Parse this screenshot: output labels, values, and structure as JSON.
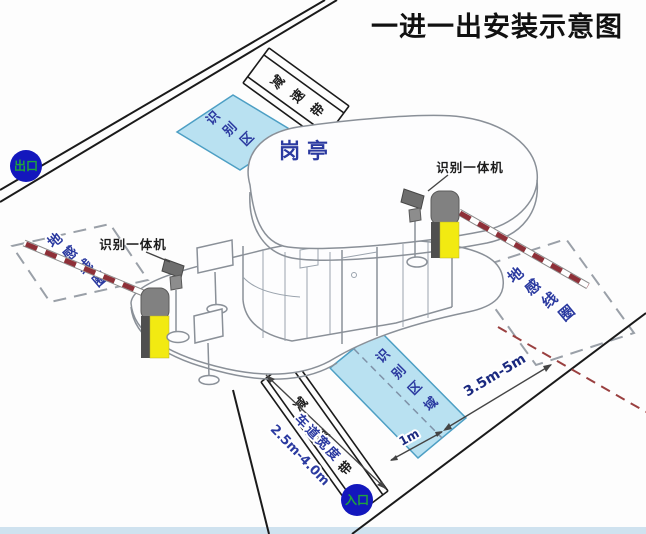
{
  "title": "一进一出安装示意图",
  "badges": {
    "exit": "出口",
    "entrance": "入口"
  },
  "booth": {
    "label": "岗亭"
  },
  "labels": {
    "camera_left": "识别一体机",
    "camera_right": "识别一体机",
    "recognition_area_chars": [
      "识",
      "别",
      "区",
      "域"
    ],
    "ground_loop_chars": [
      "地",
      "感",
      "线",
      "圈"
    ],
    "speed_bump_chars": [
      "减",
      "速",
      "带"
    ],
    "lane_width_title": "车道宽度",
    "lane_width_value": "2.5m-4.0m"
  },
  "dimensions": {
    "loop_to_area": "3.5m-5m",
    "area_to_lane": "1m"
  },
  "colors": {
    "accent_blue": "#2b3aa0",
    "area_fill": "#b9e1f1",
    "area_border": "#4d9fc4",
    "machine_yellow": "#f2ea12",
    "machine_gray": "#818181",
    "arm_red": "#8e3038",
    "badge_blue": "#1317bd",
    "badge_text_green": "#1fa43c",
    "loop_dash_gray": "#9aa0a8",
    "lane_center_red": "#9a4040"
  }
}
